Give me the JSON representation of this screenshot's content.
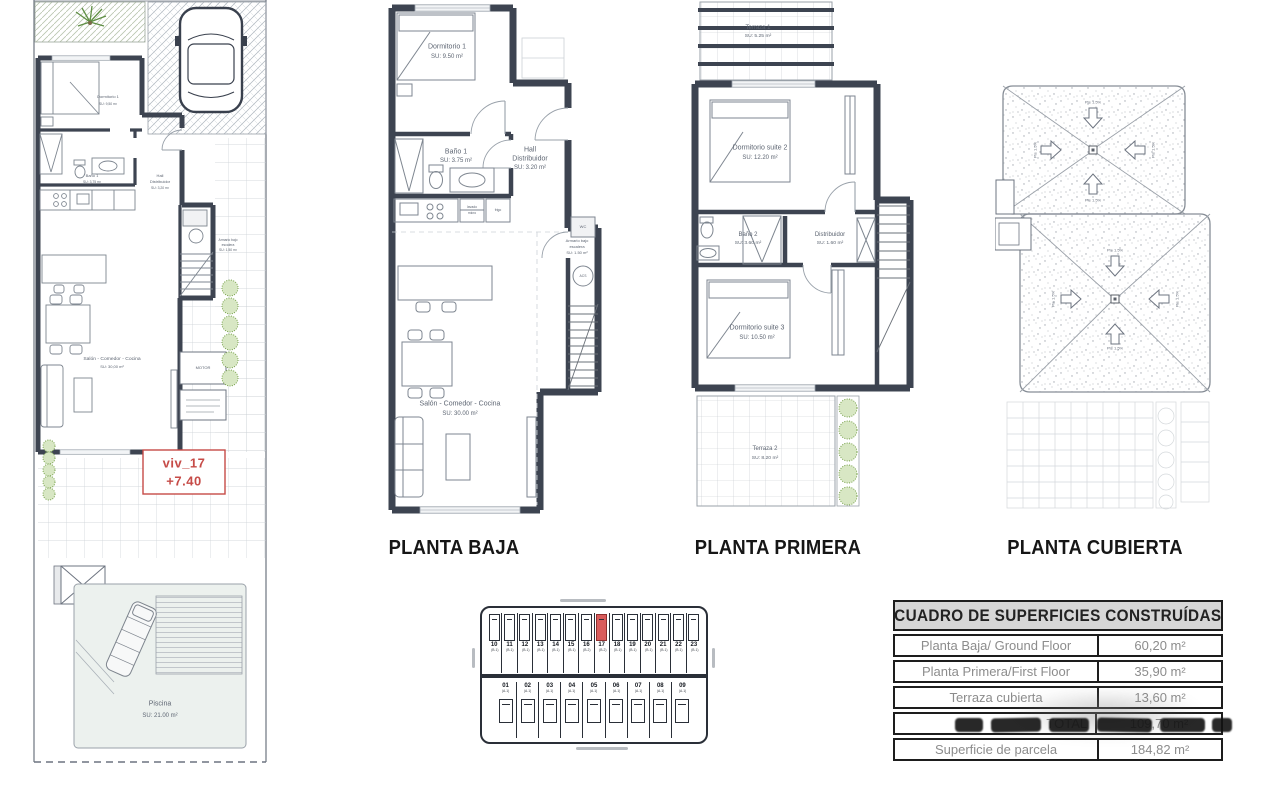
{
  "colors": {
    "wall": "#3d4451",
    "highlight_red": "#d95c5c",
    "accent_red": "#c64b47"
  },
  "titles": {
    "planta_baja": "PLANTA BAJA",
    "planta_primera": "PLANTA PRIMERA",
    "planta_cubierta": "PLANTA CUBIERTA"
  },
  "site_plan": {
    "unit_ref": "viv_17",
    "level": "+7.40",
    "dormitorio1": "Dormitorio 1",
    "dormitorio1_area": "SU: 9,50 m²",
    "bano1": "Baño 1",
    "bano1_area": "SU: 3,75 m²",
    "hall1": "Hall",
    "hall2": "Distribuidor",
    "hall_area": "SU: 3,20 m²",
    "salon": "Salón - Comedor - Cocina",
    "salon_area": "SU: 30,00 m²",
    "armario1": "Armario bajo",
    "armario2": "escalera",
    "armario_area": "SU: 1,50 m²",
    "motor": "MOTOR",
    "piscina": "Piscina",
    "piscina_area": "SU: 21.00 m²"
  },
  "planta_baja": {
    "dormitorio1": "Dormitorio 1",
    "dormitorio1_area": "SU: 9.50 m²",
    "bano1": "Baño 1",
    "bano1_area": "SU: 3.75 m²",
    "hall1": "Hall",
    "hall2": "Distribuidor",
    "hall_area": "SU: 3.20 m²",
    "armario1": "Armario bajo",
    "armario2": "escalera",
    "armario_area": "SU: 1.50 m²",
    "salon": "Salón - Comedor - Cocina",
    "salon_area": "SU: 30.00 m²",
    "wc": "WC",
    "acs": "ACS",
    "lavado": "lavado",
    "micro": "micro",
    "frigo": "frigo"
  },
  "planta_primera": {
    "terraza1": "Terraza 1",
    "terraza1_area": "SU: 5.25 m²",
    "suite2": "Dormitorio suite 2",
    "suite2_area": "SU: 12.20 m²",
    "bano2": "Baño 2",
    "bano2_area": "SU: 3.60 m²",
    "distribuidor": "Distribuidor",
    "distribuidor_area": "SU: 1.60 m²",
    "suite3": "Dormitorio suite 3",
    "suite3_area": "SU: 10.50 m²",
    "terraza2": "Terraza 2",
    "terraza2_area": "SU: 8.20 m²"
  },
  "planta_cubierta": {
    "slope_label": "Pte 1.5%"
  },
  "keyplan": {
    "highlight": "17",
    "top_units": [
      {
        "num": "10",
        "type": "(B.1)"
      },
      {
        "num": "11",
        "type": "(B.1)"
      },
      {
        "num": "12",
        "type": "(B.1)"
      },
      {
        "num": "13",
        "type": "(B.1)"
      },
      {
        "num": "14",
        "type": "(B.1)"
      },
      {
        "num": "15",
        "type": "(B.1)"
      },
      {
        "num": "16",
        "type": "(B.2)"
      },
      {
        "num": "17",
        "type": "(B.2)"
      },
      {
        "num": "18",
        "type": "(B.1)"
      },
      {
        "num": "19",
        "type": "(B.1)"
      },
      {
        "num": "20",
        "type": "(B.1)"
      },
      {
        "num": "21",
        "type": "(B.1)"
      },
      {
        "num": "22",
        "type": "(B.1)"
      },
      {
        "num": "23",
        "type": "(B.1)"
      }
    ],
    "bottom_units": [
      {
        "num": "01",
        "type": "(A.1)"
      },
      {
        "num": "02",
        "type": "(A.1)"
      },
      {
        "num": "03",
        "type": "(A.1)"
      },
      {
        "num": "04",
        "type": "(A.1)"
      },
      {
        "num": "05",
        "type": "(A.1)"
      },
      {
        "num": "06",
        "type": "(A.1)"
      },
      {
        "num": "07",
        "type": "(A.1)"
      },
      {
        "num": "08",
        "type": "(A.1)"
      },
      {
        "num": "09",
        "type": "(A.1)"
      }
    ]
  },
  "table": {
    "title": "CUADRO DE SUPERFICIES CONSTRUÍDAS",
    "rows": [
      {
        "label": "Planta Baja/ Ground Floor",
        "value": "60,20 m²"
      },
      {
        "label": "Planta Primera/First Floor",
        "value": "35,90 m²"
      },
      {
        "label": "Terraza cubierta",
        "value": "13,60 m²"
      },
      {
        "label": "TOTAL",
        "value": "109,70 m²"
      },
      {
        "label": "Superficie de parcela",
        "value": "184,82 m²"
      }
    ]
  }
}
